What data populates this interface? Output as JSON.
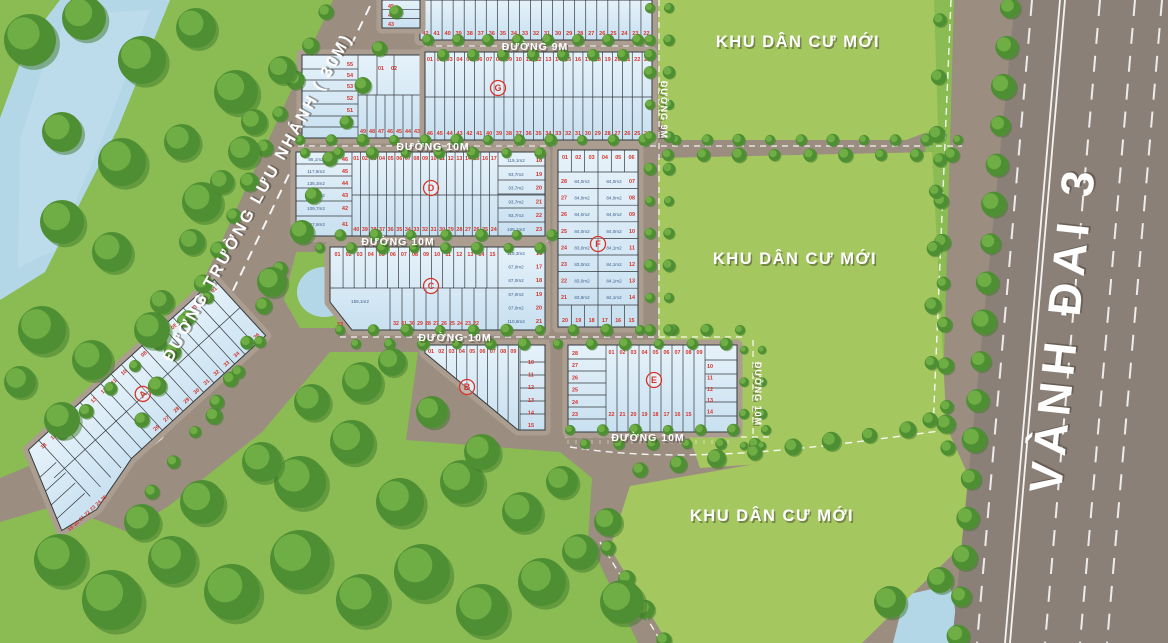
{
  "map": {
    "title": "Residential land subdivision master plan",
    "road_labels": {
      "main_road": "ĐƯỜNG TRƯỜNG LƯU NHÁNH ( 30M)",
      "ring_road": "VÀNH ĐAI 3",
      "road_9m": "ĐƯỜNG 9M",
      "road_10m": "ĐƯỜNG 10M",
      "residential_area": "KHU DÂN CƯ MỚI"
    },
    "colors": {
      "lot_fill": "#cfe4f2",
      "lot_fill_light": "#e3f0f8",
      "lot_stroke": "#34393d",
      "lot_number_red": "#d6342a",
      "area_text_blue": "#3f618e",
      "road": "#9b8d80",
      "sidewalk": "#ab9e91",
      "highway": "#8b8077",
      "green_area": "#a5c75f",
      "park_green": "#8abc53",
      "tree_dark": "#4f8f33",
      "tree_light": "#6fae45",
      "water": "#b4d7e8",
      "label_white": "#ffffff"
    },
    "residential_labels": [
      {
        "text": "KHU DÂN CƯ MỚI"
      },
      {
        "text": "KHU DÂN CƯ MỚI"
      },
      {
        "text": "KHU DÂN CƯ MỚI"
      }
    ],
    "top_strip": {
      "numbers": [
        "42",
        "41",
        "40",
        "39",
        "38",
        "37",
        "36",
        "35",
        "34",
        "33",
        "32",
        "31",
        "30",
        "29",
        "28",
        "27",
        "26",
        "25",
        "24",
        "23",
        "22"
      ],
      "west_numbers": [
        "45",
        "44",
        "43"
      ]
    },
    "nw_block": {
      "stacked": [
        "55",
        "54",
        "53",
        "52",
        "51",
        "50"
      ],
      "bottom_row": [
        "49",
        "48",
        "47",
        "46",
        "45",
        "44",
        "43"
      ],
      "corner": [
        "01",
        "02"
      ]
    },
    "blocks": {
      "G": {
        "letter": "G",
        "top_row": [
          "01",
          "02",
          "03",
          "04",
          "05",
          "06",
          "07",
          "08",
          "09",
          "10",
          "11",
          "12",
          "13",
          "14",
          "15",
          "16",
          "17",
          "18",
          "19",
          "20",
          "21",
          "22",
          "23"
        ],
        "bottom_row": [
          "46",
          "45",
          "44",
          "43",
          "42",
          "41",
          "40",
          "39",
          "38",
          "37",
          "36",
          "35",
          "34",
          "33",
          "32",
          "31",
          "30",
          "29",
          "28",
          "27",
          "26",
          "25",
          "24"
        ]
      },
      "D": {
        "letter": "D",
        "top_row": [
          "01",
          "02",
          "03",
          "04",
          "05",
          "06",
          "07",
          "08",
          "09",
          "10",
          "11",
          "12",
          "13",
          "14",
          "15",
          "16",
          "17"
        ],
        "bottom_row": [
          "40",
          "39",
          "38",
          "37",
          "36",
          "35",
          "34",
          "33",
          "32",
          "31",
          "30",
          "29",
          "28",
          "27",
          "26",
          "25",
          "24"
        ],
        "left_col": [
          {
            "no": "46",
            "area": "95,1m2"
          },
          {
            "no": "45",
            "area": "117,8m2"
          },
          {
            "no": "44",
            "area": "135,3m2"
          },
          {
            "no": "43",
            "area": "146,8m2"
          },
          {
            "no": "42",
            "area": "109,7m2"
          },
          {
            "no": "41",
            "area": "527,8m2"
          }
        ],
        "right_col": [
          {
            "no": "18",
            "area": "119,1m2"
          },
          {
            "no": "19",
            "area": "93,7m2"
          },
          {
            "no": "20",
            "area": "93,7m2"
          },
          {
            "no": "21",
            "area": "93,7m2"
          },
          {
            "no": "22",
            "area": "93,7m2"
          },
          {
            "no": "23",
            "area": "105,1m2"
          }
        ]
      },
      "C": {
        "letter": "C",
        "top_row": [
          "01",
          "02",
          "03",
          "04",
          "05",
          "06",
          "07",
          "08",
          "09",
          "10",
          "11",
          "12",
          "13",
          "14",
          "15"
        ],
        "bottom_row": [
          "32",
          "31",
          "30",
          "29",
          "28",
          "27",
          "26",
          "25",
          "24",
          "23",
          "22"
        ],
        "big_lot": {
          "no": "33",
          "area": "159,1m2"
        },
        "right_col": [
          {
            "no": "16",
            "area": "119,3m2"
          },
          {
            "no": "17",
            "area": "67,0m2"
          },
          {
            "no": "18",
            "area": "67,0m2"
          },
          {
            "no": "19",
            "area": "67,0m2"
          },
          {
            "no": "20",
            "area": "67,0m2"
          },
          {
            "no": "21",
            "area": "110,8m2"
          }
        ]
      },
      "F": {
        "letter": "F",
        "top_row": [
          "01",
          "02",
          "03",
          "04",
          "05",
          "06"
        ],
        "bottom_row": [
          "20",
          "19",
          "18",
          "17",
          "16",
          "15"
        ],
        "left_col": [
          {
            "no": "28",
            "area": "84,0m2"
          },
          {
            "no": "27",
            "area": "84,0m2"
          },
          {
            "no": "26",
            "area": "84,0m2"
          },
          {
            "no": "25",
            "area": "84,0m2"
          },
          {
            "no": "24",
            "area": "83,0m2"
          },
          {
            "no": "23",
            "area": "83,0m2"
          },
          {
            "no": "22",
            "area": "83,0m2"
          },
          {
            "no": "21",
            "area": "83,9m2"
          }
        ],
        "right_col": [
          {
            "no": "07",
            "area": "84,0m2"
          },
          {
            "no": "08",
            "area": "84,0m2"
          },
          {
            "no": "09",
            "area": "84,0m2"
          },
          {
            "no": "10",
            "area": "84,0m2"
          },
          {
            "no": "11",
            "area": "84,1m2"
          },
          {
            "no": "12",
            "area": "84,1m2"
          },
          {
            "no": "13",
            "area": "84,1m2"
          },
          {
            "no": "14",
            "area": "84,1m2"
          }
        ]
      },
      "B": {
        "letter": "B",
        "top_row": [
          "01",
          "02",
          "03",
          "04",
          "05",
          "06",
          "07",
          "08",
          "09"
        ],
        "right_col": [
          "10",
          "11",
          "12",
          "13",
          "14",
          "15"
        ]
      },
      "E": {
        "letter": "E",
        "top_row": [
          "01",
          "02",
          "03",
          "04",
          "05",
          "06",
          "07",
          "08",
          "09"
        ],
        "left_col": [
          "28",
          "27",
          "26",
          "25",
          "24",
          "23"
        ],
        "right_col": [
          "10",
          "11",
          "12",
          "13",
          "14"
        ],
        "bottom_row": [
          "22",
          "21",
          "20",
          "19",
          "18",
          "17",
          "16",
          "15"
        ]
      },
      "A": {
        "letter": "A",
        "nw_edge": [
          "01",
          "02",
          "03",
          "04",
          "05",
          "06",
          "07",
          "08",
          "09",
          "10",
          "11",
          "12",
          "13",
          "14",
          "15",
          "16",
          "17",
          "18"
        ],
        "south_edge": [
          "19",
          "20",
          "21",
          "22",
          "23",
          "24",
          "25"
        ],
        "se_edge": [
          "36",
          "35",
          "34",
          "33",
          "32",
          "31",
          "30",
          "29",
          "28",
          "27",
          "26"
        ]
      }
    }
  }
}
